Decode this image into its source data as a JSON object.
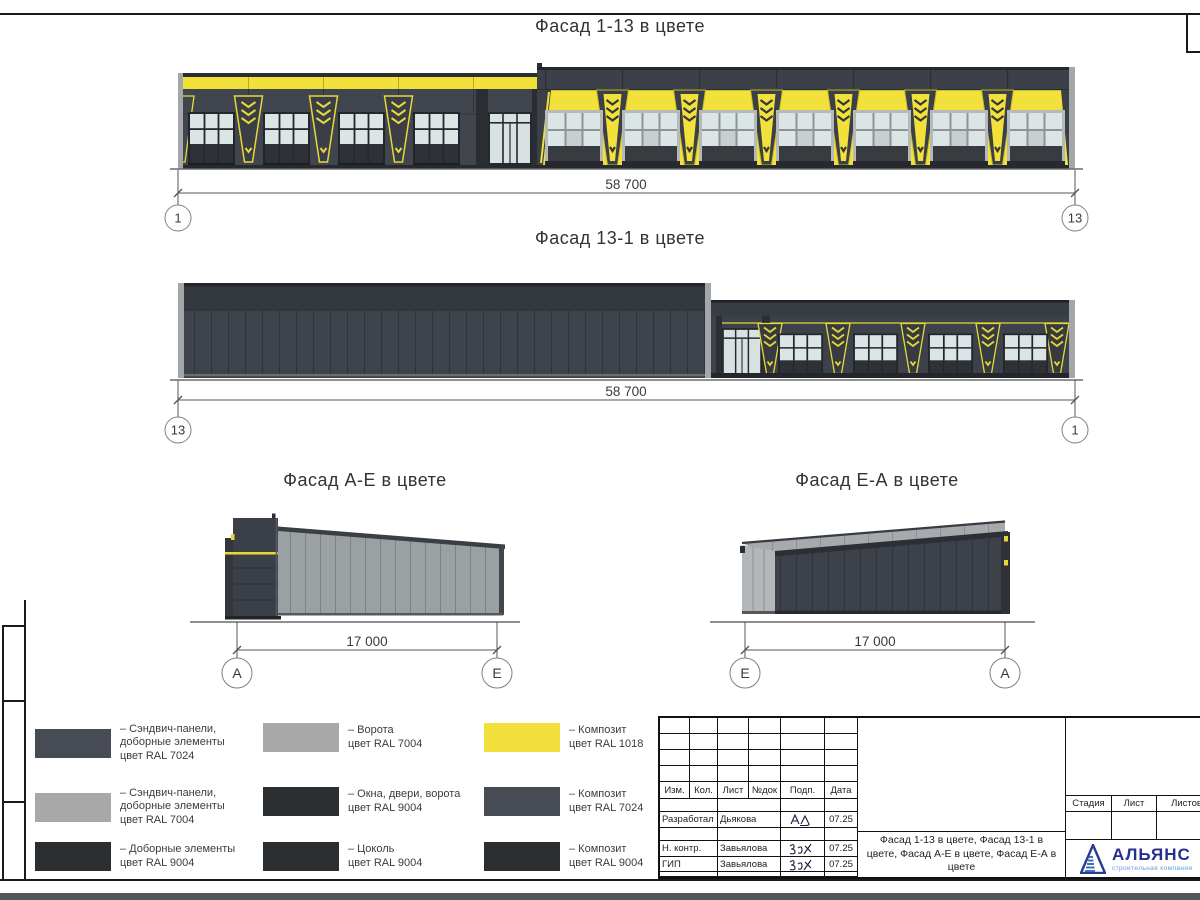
{
  "facades": {
    "f113": {
      "title": "Фасад 1-13 в цвете",
      "dim": "58 700",
      "axis_left": "1",
      "axis_right": "13"
    },
    "f131": {
      "title": "Фасад 13-1 в цвете",
      "dim": "58 700",
      "axis_left": "13",
      "axis_right": "1"
    },
    "fae": {
      "title": "Фасад А-Е в цвете",
      "dim": "17 000",
      "axis_left": "А",
      "axis_right": "Е"
    },
    "fea": {
      "title": "Фасад Е-А в цвете",
      "dim": "17 000",
      "axis_left": "Е",
      "axis_right": "А"
    }
  },
  "legend": {
    "items": [
      {
        "text": "– Сэндвич-панели,\nдоборные элементы\nцвет RAL 7024",
        "color": "#474b54"
      },
      {
        "text": "– Сэндвич-панели,\nдоборные элементы\nцвет RAL 7004",
        "color": "#a8a8a8"
      },
      {
        "text": "– Доборные элементы\nцвет RAL 9004",
        "color": "#2b2e31"
      },
      {
        "text": "– Ворота\nцвет RAL 7004",
        "color": "#a8a8a8"
      },
      {
        "text": "– Окна, двери, ворота\nцвет RAL 9004",
        "color": "#2b2e31"
      },
      {
        "text": "– Цоколь\nцвет RAL 9004",
        "color": "#2b2e31"
      },
      {
        "text": "– Композит\nцвет RAL 1018",
        "color": "#f1df3b"
      },
      {
        "text": "– Композит\nцвет RAL 7024",
        "color": "#474b54"
      },
      {
        "text": "– Композит\nцвет RAL 9004",
        "color": "#2b2e31"
      }
    ]
  },
  "titleblock": {
    "headers": [
      "Изм.",
      "Кол.",
      "Лист",
      "№док",
      "Подп.",
      "Дата"
    ],
    "rows": [
      {
        "role": "Разработал",
        "name": "Дьякова",
        "date": "07.25"
      },
      {
        "role": "Н. контр.",
        "name": "Завьялова",
        "date": "07.25"
      },
      {
        "role": "ГИП",
        "name": "Завьялова",
        "date": "07.25"
      }
    ],
    "doc_title": "Фасад 1-13 в цвете, Фасад 13-1 в цвете, Фасад А-Е в цвете, Фасад Е-А в цвете",
    "stage_headers": [
      "Стадия",
      "Лист",
      "Листов"
    ],
    "logo": {
      "name": "АЛЬЯНС",
      "subtitle": "строительная компания"
    }
  },
  "colors": {
    "ral_1018": "#f1df3b",
    "ral_7024": "#474b54",
    "ral_7004": "#a8a8a8",
    "ral_9004": "#2b2e31",
    "logo_blue": "#272f8e",
    "logo_light_blue": "#5b9bd5"
  }
}
